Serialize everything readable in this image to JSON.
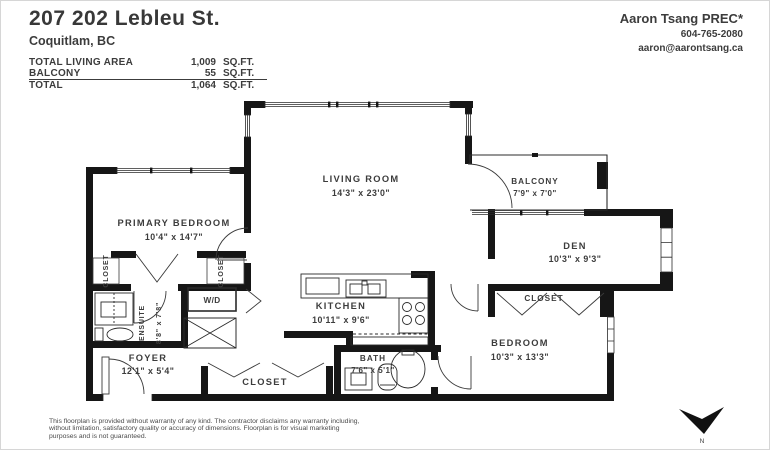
{
  "colors": {
    "wall": "#161616",
    "text": "#3c3c3c",
    "background": "#ffffff"
  },
  "header": {
    "title": "207 202 Lebleu St.",
    "subtitle": "Coquitlam, BC",
    "area_table": {
      "rows": [
        {
          "label": "TOTAL LIVING AREA",
          "value": "1,009",
          "unit": "SQ.FT."
        },
        {
          "label": "BALCONY",
          "value": "55",
          "unit": "SQ.FT."
        },
        {
          "label": "TOTAL",
          "value": "1,064",
          "unit": "SQ.FT."
        }
      ]
    },
    "agent": {
      "name": "Aaron Tsang PREC*",
      "phone": "604-765-2080",
      "email": "aaron@aarontsang.ca"
    }
  },
  "plan": {
    "rooms": [
      {
        "name": "LIVING ROOM",
        "dims": "14'3\" x 23'0\""
      },
      {
        "name": "PRIMARY BEDROOM",
        "dims": "10'4\" x 14'7\""
      },
      {
        "name": "BALCONY",
        "dims": "7'9\" x 7'0\""
      },
      {
        "name": "DEN",
        "dims": "10'3\" x 9'3\""
      },
      {
        "name": "KITCHEN",
        "dims": "10'11\" x 9'6\""
      },
      {
        "name": "BEDROOM",
        "dims": "10'3\" x 13'3\""
      },
      {
        "name": "BATH",
        "dims": "7'6\" x 5'1\""
      },
      {
        "name": "ENSUITE",
        "dims": "8'8\" x 7'8\""
      },
      {
        "name": "FOYER",
        "dims": "12'1\" x 5'4\""
      }
    ],
    "labels": {
      "closet": "CLOSET",
      "wd": "W/D",
      "north": "N"
    }
  },
  "footer": {
    "disclaimer": {
      "line1": "This floorplan is provided without warranty of any kind. The contractor disclaims any warranty including,",
      "line2": "without limitation, satisfactory quality or accuracy of dimensions. Floorplan is for visual marketing",
      "line3": "purposes and is not guaranteed."
    }
  }
}
